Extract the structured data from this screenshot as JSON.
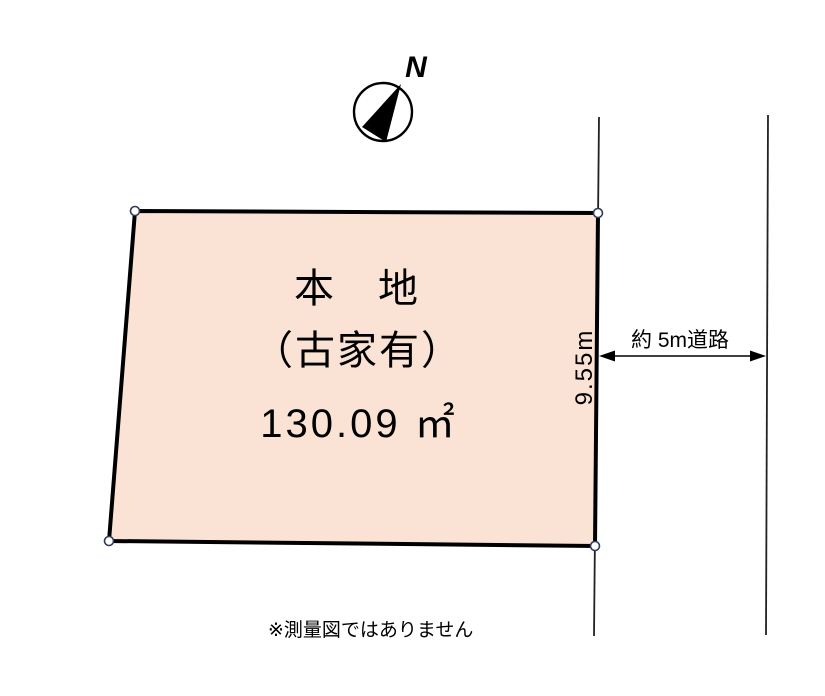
{
  "colors": {
    "background": "#ffffff",
    "parcel_fill": "#fae3d4",
    "outline": "#000000",
    "vertex_marker_stroke": "#2e3a5e",
    "road_line": "#222222"
  },
  "compass": {
    "north_label": "N"
  },
  "parcel": {
    "title": "本　地",
    "subtitle": "（古家有）",
    "area": "130.09 ㎡",
    "frontage": "9.55m"
  },
  "road": {
    "width_label": "約 5m道路"
  },
  "footnote": {
    "text": "※測量図ではありません"
  }
}
